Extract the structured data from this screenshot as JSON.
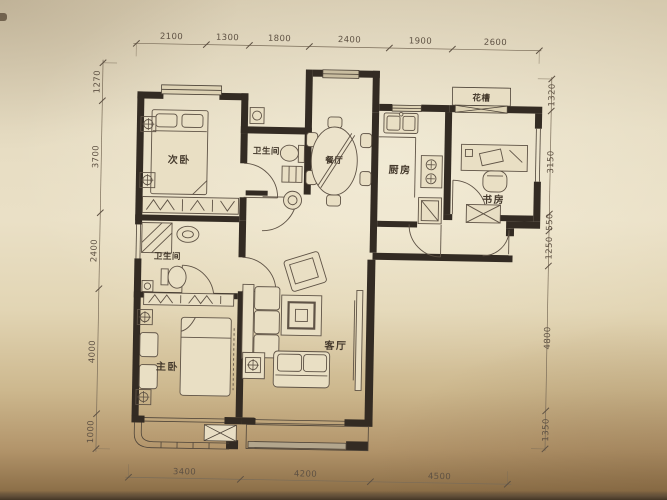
{
  "document": {
    "kind": "architectural floor plan, photographed on paper",
    "units_note": "dimensions in millimetres"
  },
  "colors": {
    "paper": "#e6dcc2",
    "paper_shadow": "#8d7049",
    "wall": "#332b23",
    "furniture_line": "#5f5346",
    "window_sill": "#b3a68d",
    "dimension_text": "#5e5143"
  },
  "rooms": {
    "secondary_bedroom": "次卧",
    "bath_top": "卫生间",
    "dining": "餐厅",
    "kitchen": "厨房",
    "flower_box": "花槽",
    "study": "书房",
    "bath_left": "卫生间",
    "master_bedroom": "主卧",
    "living": "客厅"
  },
  "dimensions": {
    "top": [
      "2100",
      "1300",
      "1800",
      "2400",
      "1900",
      "2600"
    ],
    "left": [
      "1270",
      "3700",
      "2400",
      "4000",
      "1000"
    ],
    "right": [
      "1320",
      "3150",
      "550",
      "1250",
      "4800",
      "1350"
    ],
    "bottom": [
      "3400",
      "4200",
      "4500"
    ]
  }
}
